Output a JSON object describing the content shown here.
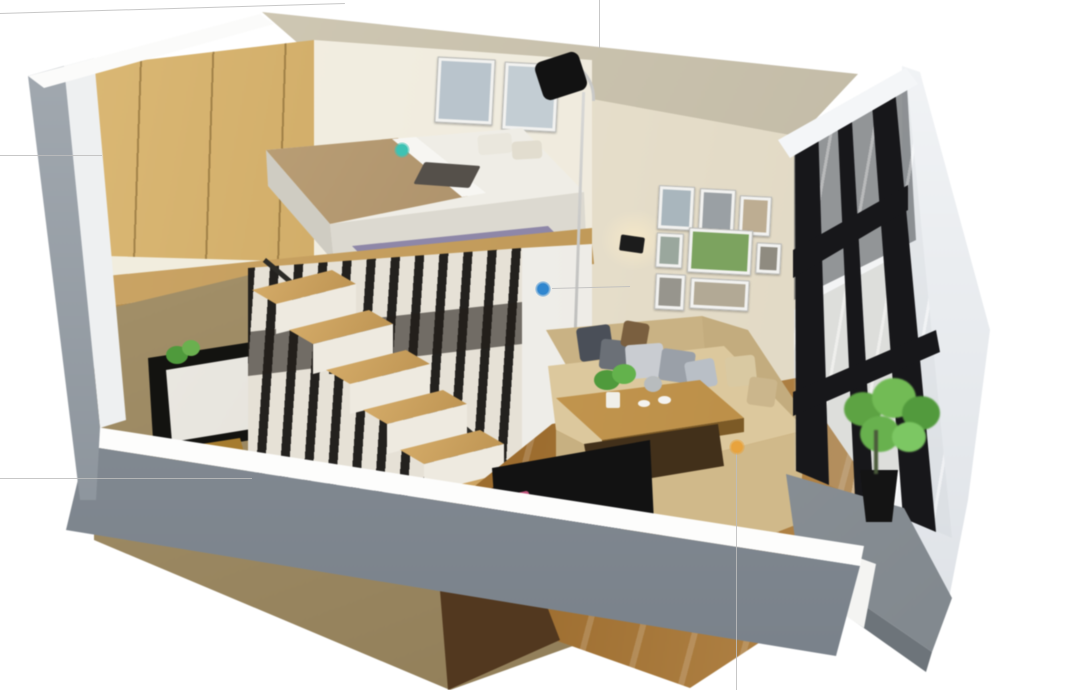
{
  "scene": {
    "title": "3D cutaway rendering of a duplex loft studio apartment",
    "background_color": "#ffffff",
    "areas": [
      "loft bedroom",
      "wardrobe",
      "staircase",
      "under-loft storage closet",
      "bathroom niche",
      "living room",
      "gallery wall",
      "window wall",
      "balcony"
    ]
  },
  "palette": {
    "exterior_wall_gray": "#8f969d",
    "interior_wall_cream": "#e9e2d0",
    "ceiling_tan": "#c8c0ab",
    "wardrobe_oak": "#c9a35c",
    "loft_floor_oak": "#c09a5b",
    "stair_tread_oak": "#c59e60",
    "living_floor_wood": "#a97834",
    "sofa_beige": "#d8c398",
    "window_frame_black": "#17171a",
    "balcony_concrete": "#8d939a",
    "plant_green": "#68b14e",
    "rug_purple": "#8e87a8",
    "tv_cabinet_black": "#121212",
    "accent_pink": "#c2547c"
  },
  "hotspots": [
    {
      "name": "loft-bedroom-hotspot",
      "color": "#3ec2b3",
      "x": 402,
      "y": 150
    },
    {
      "name": "under-loft-storage-hotspot",
      "color": "#2f86cf",
      "x": 543,
      "y": 289
    },
    {
      "name": "living-room-hotspot",
      "color": "#e8a33d",
      "x": 737,
      "y": 447
    }
  ],
  "guide_lines": [
    {
      "name": "top-left-line",
      "x1": 0,
      "y1": 13,
      "x2": 345,
      "y2": 3
    },
    {
      "name": "top-center-vertical-line",
      "x1": 600,
      "y1": 0,
      "x2": 600,
      "y2": 48
    },
    {
      "name": "left-upper-line",
      "x1": 0,
      "y1": 155,
      "x2": 102,
      "y2": 155
    },
    {
      "name": "left-lower-line",
      "x1": 0,
      "y1": 478,
      "x2": 252,
      "y2": 478
    },
    {
      "name": "blue-hotspot-line",
      "x1": 552,
      "y1": 288,
      "x2": 630,
      "y2": 286
    },
    {
      "name": "orange-hotspot-line",
      "x1": 737,
      "y1": 452,
      "x2": 737,
      "y2": 690
    }
  ],
  "stairs": {
    "visible_steps": 8
  },
  "gallery_wall": {
    "frame_count": 8
  },
  "bedroom_wall_frames": {
    "frame_count": 2
  }
}
